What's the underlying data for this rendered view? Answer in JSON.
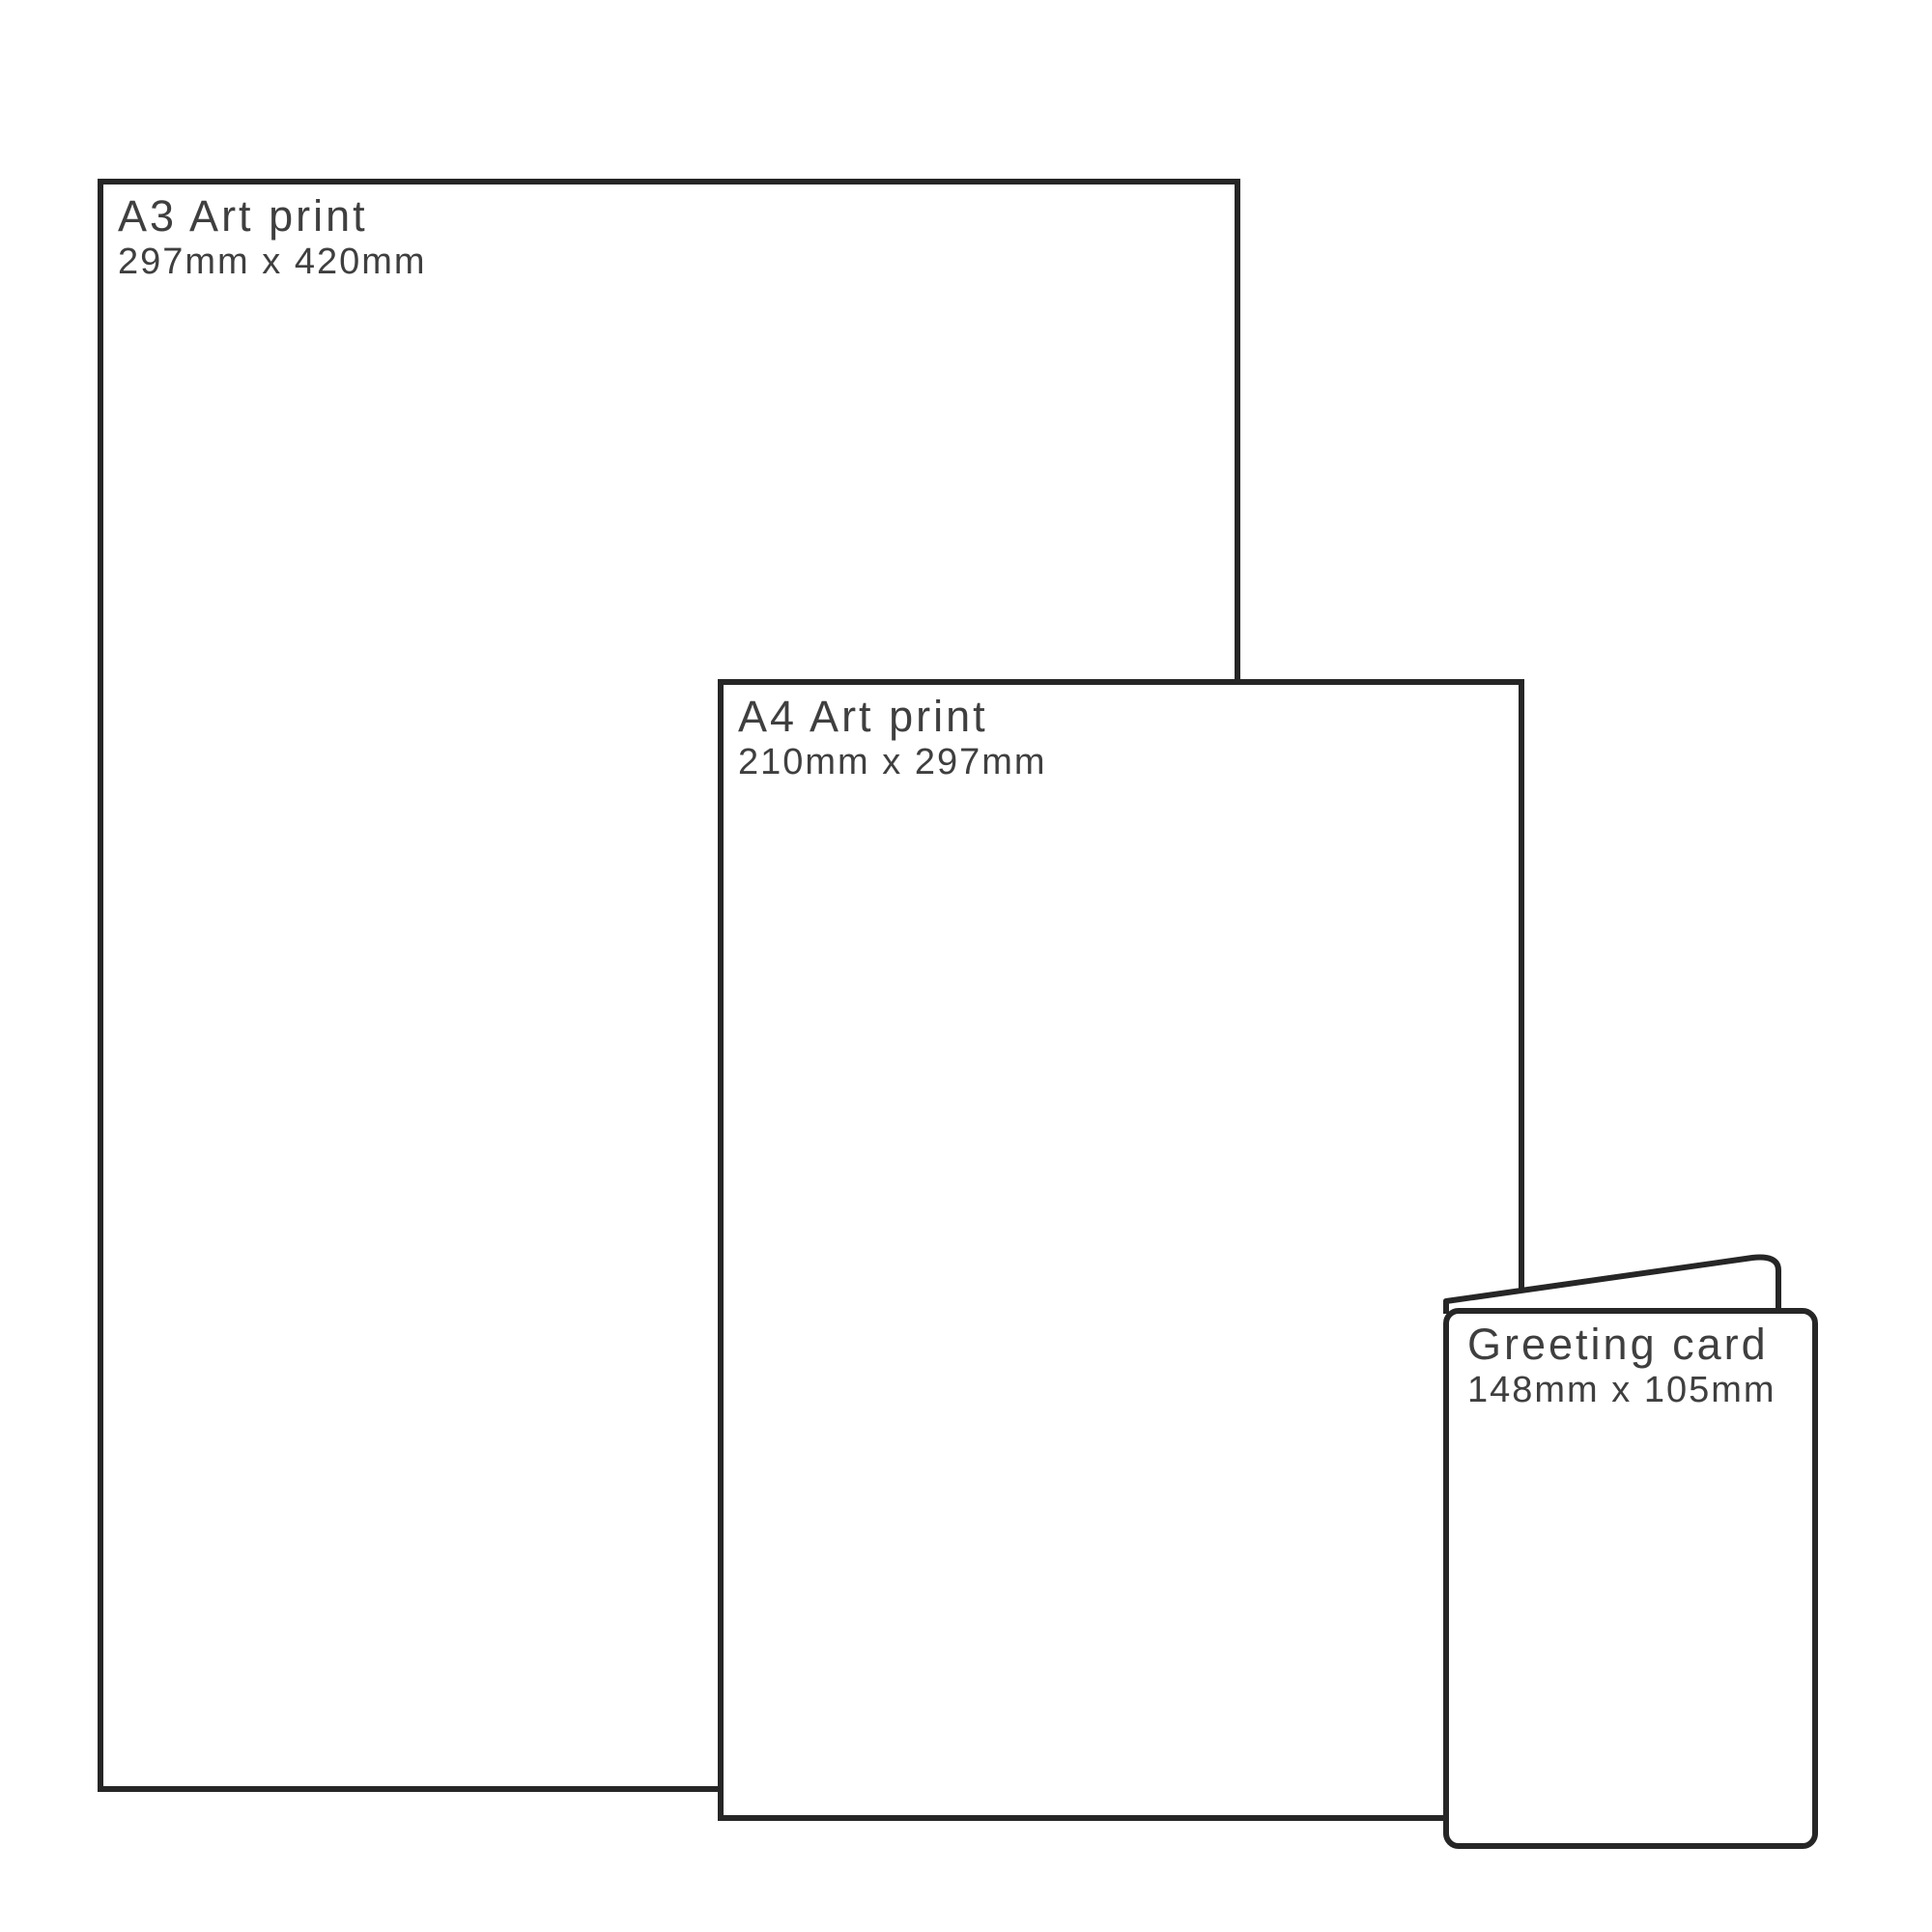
{
  "page": {
    "background_color": "#ffffff",
    "line_color": "#262626",
    "text_color": "#3f3f3f"
  },
  "items": [
    {
      "id": "a3-print",
      "title": "A3 Art print",
      "size": "297mm x 420mm"
    },
    {
      "id": "a4-print",
      "title": "A4 Art print",
      "size": "210mm x 297mm"
    },
    {
      "id": "greeting-card",
      "title": "Greeting card",
      "size": "148mm x 105mm"
    }
  ]
}
